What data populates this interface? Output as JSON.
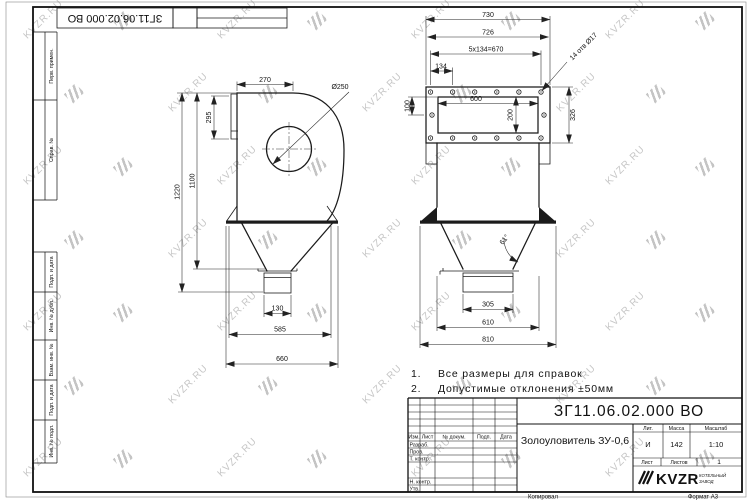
{
  "colors": {
    "paper": "#ffffff",
    "line": "#1b1b1b",
    "watermark": "#c6c6c6",
    "logo_red": "#c43030"
  },
  "sheet": {
    "watermark_text": "KVZR.RU",
    "copied_label": "Копировал",
    "format_label": "Формат А3"
  },
  "corner": {
    "designation_rotated": "ЗГ11.06.02.000 ВО"
  },
  "margin_labels": [
    "Перв. примен.",
    "Справ. №",
    "Подп. и дата",
    "Инв. № дубл.",
    "Взам. инв. №",
    "Подп. и дата",
    "Инв. № подл."
  ],
  "notes": [
    {
      "num": "1.",
      "text": "Все размеры для справок"
    },
    {
      "num": "2.",
      "text": "Допустимые отклонения ±50мм"
    }
  ],
  "left_view": {
    "d270": "270",
    "d295": "295",
    "d1220": "1220",
    "d1100": "1100",
    "dia250": "Ø250",
    "d130": "130",
    "d585": "585",
    "d660": "660"
  },
  "right_view": {
    "d730": "730",
    "d726": "726",
    "d670": "5x134=670",
    "d134": "134",
    "holes": "14 отв Ø17",
    "d100": "100",
    "d600": "600",
    "d200": "200",
    "d326": "326",
    "angle": "61°",
    "d305": "305",
    "d610": "610",
    "d810": "810"
  },
  "title_block": {
    "designation": "ЗГ11.06.02.000 ВО",
    "name": "Золоуловитель ЗУ-0,6",
    "lit_label": "Лит.",
    "lit_value": "И",
    "mass_label": "Масса",
    "mass_value": "142",
    "scale_label": "Масштаб",
    "scale_value": "1:10",
    "sheet_label": "Лист",
    "sheets_label": "Листов",
    "sheets_value": "1",
    "col_izm": "Изм.",
    "col_list": "Лист",
    "col_doc": "№ докум.",
    "col_podp": "Подп.",
    "col_data": "Дата",
    "row_razrab": "Разраб.",
    "row_prov": "Пров.",
    "row_tkontr": "Т. контр.",
    "row_nkontr": "Н. контр.",
    "row_utv": "Утв.",
    "logo_text": "KVZR",
    "logo_sub_line1": "КОТЕЛЬНЫЙ",
    "logo_sub_line2": "ЗАВОД"
  }
}
